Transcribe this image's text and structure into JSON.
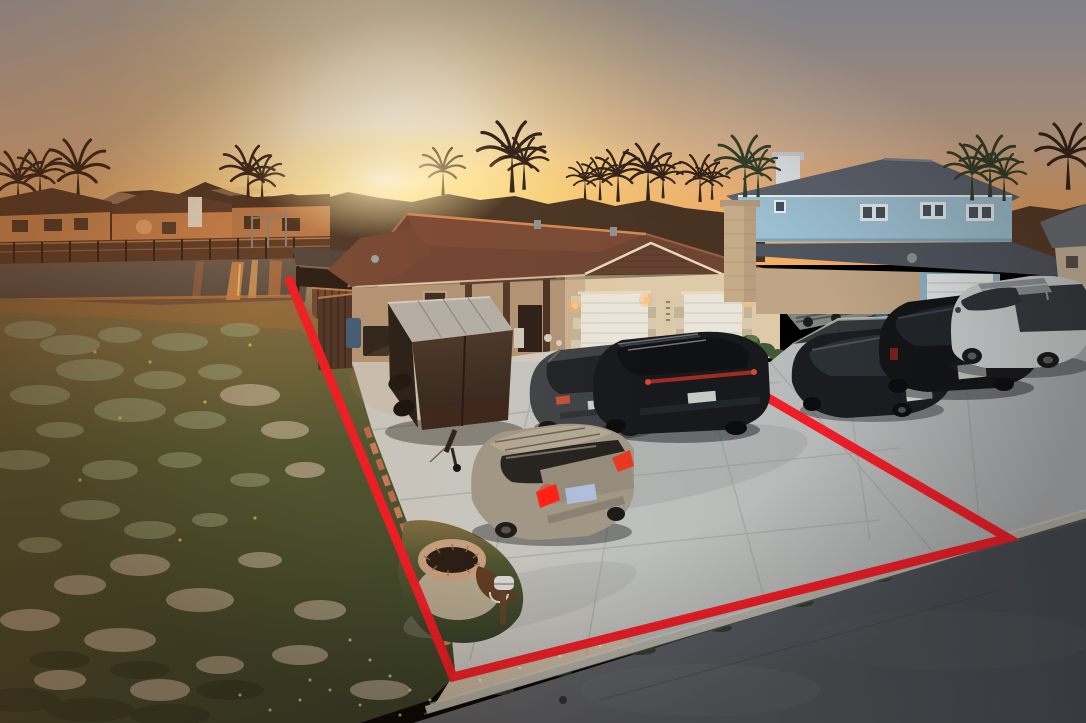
{
  "scene": {
    "description": "Aerial drone photo at sunset of a waterfront lot with a single-story stucco duplex, driveway full of vehicles, vacant grass yard, canal with docks behind, and a red property boundary outline drawn on the pavement and lawn",
    "time_of_day": "sunset",
    "vehicle_count": 7,
    "objects": [
      "sunset sky",
      "sun glow",
      "palm tree silhouettes",
      "waterfront houses across canal",
      "boat docks",
      "canal water",
      "covered boat dock",
      "vacant grass lot",
      "sand patches",
      "brick lawn edging",
      "stone fire pit",
      "mailbox",
      "single-story stucco house with two-car garage",
      "cargo trailer",
      "dark gray SUV",
      "black SUV",
      "silver SUV",
      "black sedan",
      "black full-size SUV",
      "white pickup truck",
      "trash bins",
      "boat trailer",
      "two-story blue house",
      "tan brick chimney",
      "concrete driveway",
      "curb and gutter",
      "asphalt street",
      "red property boundary outline"
    ]
  },
  "boundary": {
    "color": "#f11722",
    "stroke_width": 9,
    "points": "288,277 453,677 1008,538 763,395"
  },
  "palette": {
    "sky_top": "#9fa6b4",
    "sky_mid": "#d4b294",
    "sky_horizon": "#f2a65c",
    "sun_core": "#fffdf0",
    "sun_glow": "#ffdf9a",
    "horizon_glow": "#ffe676",
    "silhouette": "#3a281d",
    "palm_silhouette": "#33231a",
    "canal_house_wall": "#cf8a52",
    "canal_house_roof": "#553827",
    "dock_wood": "#7c5335",
    "water": "#695b4e",
    "water_reflection": "#d3824a",
    "grass_top": "#7d6a42",
    "grass_mid": "#49522f",
    "grass_low": "#2f3b25",
    "sand": "#c7b9a2",
    "brick_edging": "#b5684a",
    "roof_main": "#6e4433",
    "wall_main": "#d9c2a2",
    "porch_shadow": "#8f6e52",
    "garage_door": "#eae5da",
    "blue_roof": "#5b626d",
    "blue_siding": "#9cc0d2",
    "brick_chimney": "#c6ab88",
    "concrete_light": "#c6c7c1",
    "concrete_shade": "#a9aeb1",
    "curb": "#b2b2a8",
    "road_light": "#5d6267",
    "road_dark": "#404850",
    "trailer_top": "#b3afa8",
    "trailer_dark": "#2b211a",
    "vehicle_dark_gray": "#3e4246",
    "vehicle_black": "#17191c",
    "vehicle_silver": "#a09786",
    "prius_black": "#1a1c1f",
    "tahoe_black": "#121417",
    "truck_white": "#ccd1d2",
    "taillight_red": "#ff2014"
  }
}
